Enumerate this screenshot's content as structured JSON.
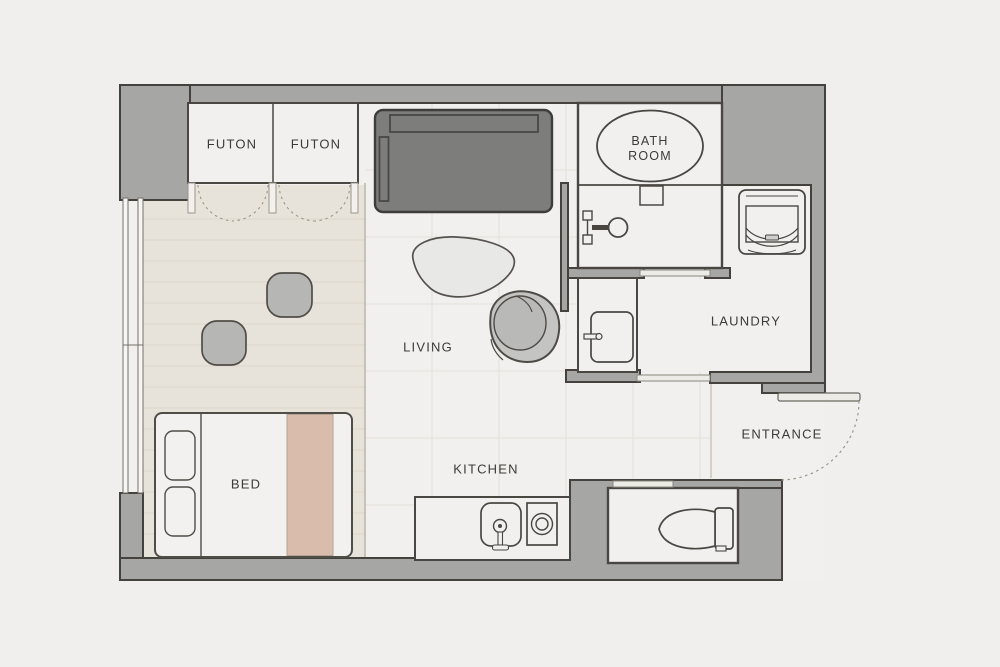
{
  "floorplan": {
    "title": "studio-apartment-floor-plan",
    "labels": {
      "futon_left": "FUTON",
      "futon_right": "FUTON",
      "bath_line1": "BATH",
      "bath_line2": "ROOM",
      "laundry": "LAUNDRY",
      "living": "LIVING",
      "entrance": "ENTRANCE",
      "bed": "BED",
      "kitchen": "KITCHEN"
    },
    "colors": {
      "background": "#f0efed",
      "floor": "#f1f0ee",
      "wall": "#a6a6a5",
      "wall_outline": "#45423e",
      "room_outline": "#4a4743",
      "tatami": "#e8e3da",
      "tatami_line": "#ddd6ca",
      "grid": "#e5e1d8",
      "sofa": "#7d7d7c",
      "furniture_gray": "#b9b9b7",
      "table": "#e8e8e6",
      "blanket": "#d9bcab",
      "label_text": "#3d3b38",
      "door_dash": "#9d968b",
      "door_fill": "#edebe6",
      "door_edge": "#8a857e"
    },
    "fixtures": [
      "bathtub-icon",
      "shower-icon",
      "vanity-sink-icon",
      "washing-machine-icon",
      "toilet-icon",
      "kitchen-sink-icon",
      "stove-burner-icon",
      "sofa-icon",
      "coffee-table-icon",
      "armchair-icon",
      "floor-cushion-icon",
      "bed-icon",
      "futon-closet-door-icon",
      "entrance-door-icon",
      "window-icon"
    ]
  }
}
